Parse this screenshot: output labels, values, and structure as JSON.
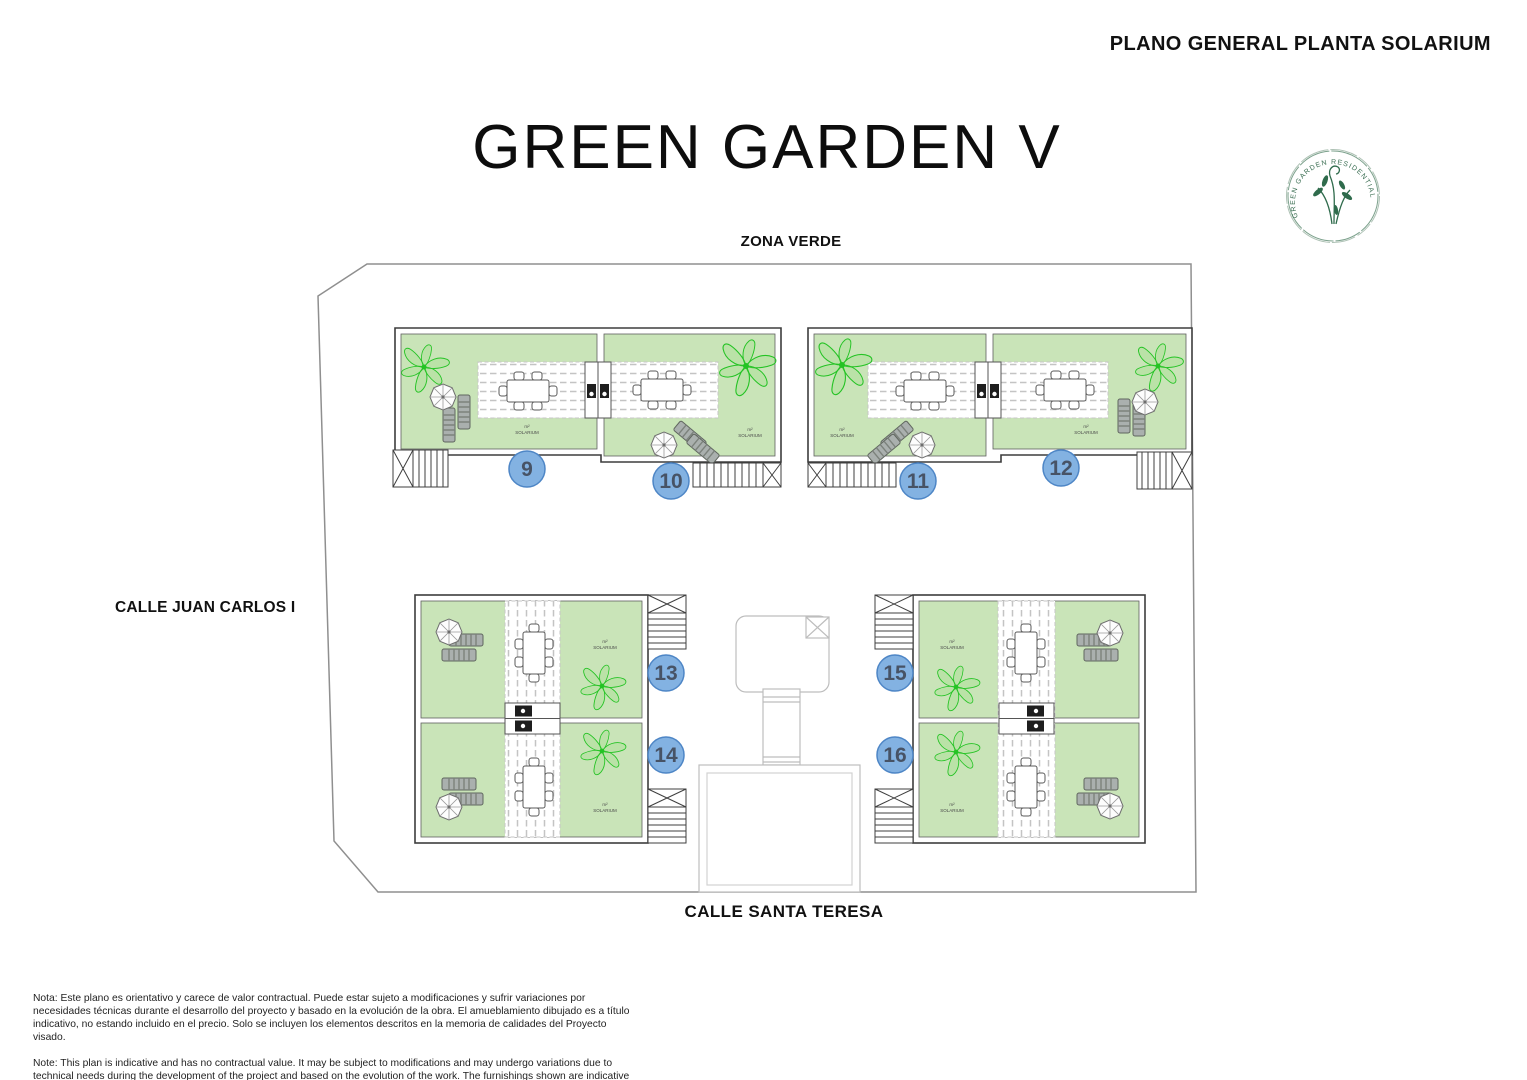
{
  "header": {
    "plan_title": "PLANO GENERAL PLANTA SOLARIUM"
  },
  "project": {
    "title": "GREEN GARDEN V"
  },
  "logo": {
    "arc_text": "GREEN GARDEN RESIDENTIAL"
  },
  "streets": {
    "top": "ZONA VERDE",
    "left": "CALLE JUAN CARLOS I",
    "bottom": "CALLE SANTA TERESA"
  },
  "units": [
    {
      "number": "9"
    },
    {
      "number": "10"
    },
    {
      "number": "11"
    },
    {
      "number": "12"
    },
    {
      "number": "13"
    },
    {
      "number": "14"
    },
    {
      "number": "15"
    },
    {
      "number": "16"
    }
  ],
  "area_label": {
    "line1": "m²",
    "line2": "SOLARIUM"
  },
  "colors": {
    "solarium_green": "#c9e4b8",
    "badge_fill": "#83b2e2",
    "badge_border": "#4e86c6",
    "palm_green": "#24c324",
    "logo_green": "#3a6e52",
    "boundary_gray": "#8f8f8f"
  },
  "notes": {
    "es": "Nota: Este plano es orientativo y carece de valor contractual. Puede estar sujeto a modificaciones y sufrir variaciones por necesidades técnicas durante el desarrollo del proyecto y basado en la evolución de la obra. El amueblamiento dibujado es a título indicativo, no estando incluido en el precio. Solo se incluyen los elementos descritos en la memoria de calidades del Proyecto visado.",
    "en": "Note: This plan is indicative and has no contractual value. It may be subject to modifications and may undergo variations due to technical needs during the development of the project and based on the evolution of the work. The furnishings shown are indicative only and are not included in the price. Only the elements described in the quality specifications of the approved project are included."
  }
}
